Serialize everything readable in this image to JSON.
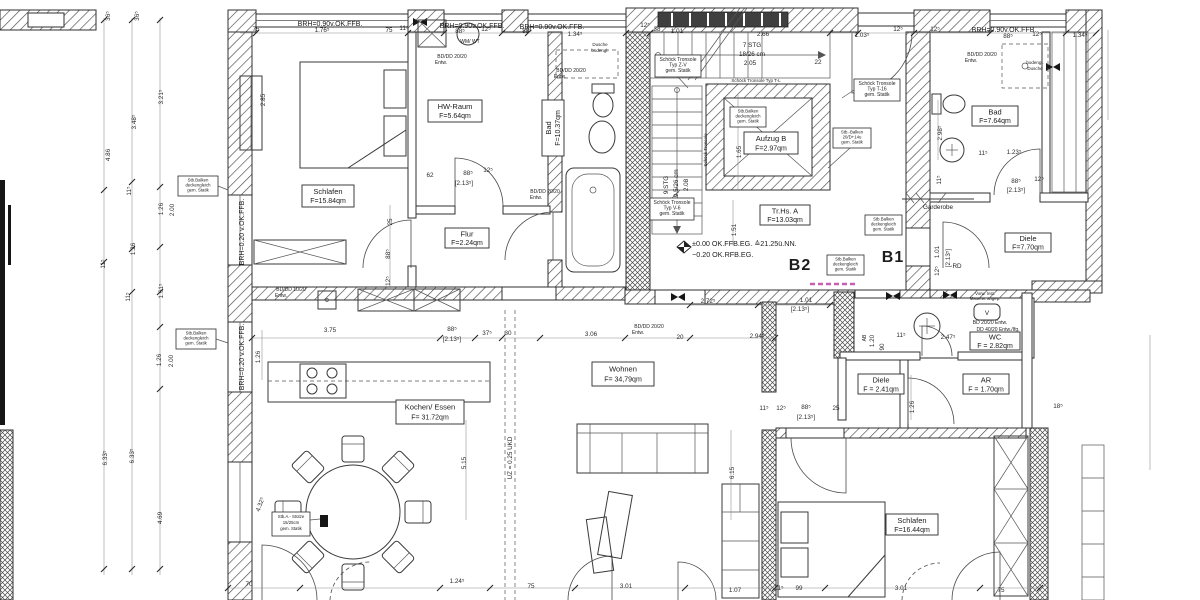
{
  "plan": {
    "units": {
      "b2": "B2",
      "b1": "B1"
    },
    "levels": {
      "l1": "±0.00  OK.FFB.EG. ≙21.25ü.NN.",
      "l2": "−0.20  OK.RFB.EG."
    },
    "rooms": [
      {
        "name": "Schlafen",
        "area": "F=15.84qm"
      },
      {
        "name": "HW-Raum",
        "area": "F=5.64qm"
      },
      {
        "name": "Bad",
        "area": "F=10.37qm"
      },
      {
        "name": "Flur",
        "area": "F=2.24qm"
      },
      {
        "name": "Kochen/ Essen",
        "area": "F= 31.72qm"
      },
      {
        "name": "Wohnen",
        "area": "F= 34,79qm"
      },
      {
        "name": "Tr.Hs.  A",
        "area": "F=13.03qm"
      },
      {
        "name": "Aufzug  B",
        "area": "F=2.97qm"
      },
      {
        "name": "Bad",
        "area": "F=7.64qm"
      },
      {
        "name": "Garderobe",
        "area": ""
      },
      {
        "name": "Diele",
        "area": "F=7.70qm"
      },
      {
        "name": "WC",
        "area": "F = 2.82qm"
      },
      {
        "name": "Diele",
        "area": "F = 2.41qm"
      },
      {
        "name": "AR",
        "area": "F = 1.70qm"
      },
      {
        "name": "Schlafen",
        "area": "F=16.44qm"
      }
    ],
    "stair": {
      "f1a": "7 STG",
      "f1b": "18/26 cm",
      "f1c": "2.05",
      "f2a": "9 STG",
      "f2b": "19,5/26 cm",
      "f2c": "2.08",
      "t1": "Schöck Tronsole Typ T-L",
      "t2": "Schöck Tronsole"
    },
    "windows": {
      "brh90": "BRH=0.90v.OK.FFB.",
      "brh20": "BRH=0.20 v.OK.FFB."
    },
    "notes": [
      {
        "l1": "Schöck Tronsole",
        "l2": "Typ Z-V",
        "l3": "gem. Statik"
      },
      {
        "l1": "Schöck Tronsole",
        "l2": "Typ T-16",
        "l3": "gem. Statik"
      },
      {
        "l1": "Schöck Tronsole",
        "l2": "Typ V-6",
        "l3": "gem. Statik"
      },
      {
        "l1": "Stb.Balken",
        "l2": "deckengleich",
        "l3": "gem. Statik"
      },
      {
        "l1": "Stb.-Balken",
        "l2": "20/D+14u",
        "l3": "gem. Statik"
      },
      {
        "l1": "Stb.Balken",
        "l2": "deckengleich",
        "l3": "gem. Statik"
      },
      {
        "l1": "Stb.Balken",
        "l2": "deckengleich",
        "l3": "gem. Statik"
      },
      {
        "l1": "Stb.Balken",
        "l2": "deckengleich",
        "l3": "gem. Statik"
      },
      {
        "l1": "Stb.Balken",
        "l2": "deckengleich",
        "l3": "gem. Statik"
      },
      {
        "l1": "Stb.A.- Stütze",
        "l2": "15/25cm",
        "l3": "gem. Statik"
      }
    ],
    "drains": [
      {
        "l1": "BD/DD 20/20",
        "l2": "Entw."
      },
      {
        "l1": "BD/DD 20/20",
        "l2": "Entw."
      },
      {
        "l1": "BD/DD 20/20",
        "l2": "Entw."
      },
      {
        "l1": "BD/DD 10/20",
        "l2": "Entw."
      },
      {
        "l1": "BD/DD 20/20",
        "l2": "Entw."
      },
      {
        "l1": "BD/DD 20/20",
        "l2": "Entw."
      },
      {
        "l1": "BD 20/20 Entw.",
        "l2": "DD 40/20 Entw./Ifg."
      }
    ],
    "misc": {
      "wm": "WM/ WT",
      "d1a": "Dusche",
      "d1b": "bodengl.",
      "d2a": "bodengl.",
      "d2b": "Dusche",
      "uz": "UZ = 0.25 UKD",
      "rd": "RD",
      "v": "V",
      "ab": "AB",
      "ab2": "1.20",
      "vorw1": "Vorw. Inst.",
      "vorw2": "Mauerw. angep."
    },
    "dims": [
      {
        "t": "36⁵",
        "x": 110,
        "y": 16,
        "r": -90
      },
      {
        "t": "36⁵",
        "x": 139,
        "y": 16,
        "r": -90
      },
      {
        "t": "3.21⁵",
        "x": 163,
        "y": 97,
        "r": -90
      },
      {
        "t": "3.48⁵",
        "x": 136,
        "y": 122,
        "r": -90
      },
      {
        "t": "4.86",
        "x": 110,
        "y": 155,
        "r": -90
      },
      {
        "t": "11⁵",
        "x": 131,
        "y": 191,
        "r": -90
      },
      {
        "t": "1.26",
        "x": 163,
        "y": 209,
        "r": -90
      },
      {
        "t": "2.00",
        "x": 174,
        "y": 210,
        "r": -90
      },
      {
        "t": "1.26",
        "x": 135,
        "y": 249,
        "r": -90
      },
      {
        "t": "11⁵",
        "x": 105,
        "y": 264,
        "r": -90
      },
      {
        "t": "1.61⁵",
        "x": 163,
        "y": 291,
        "r": -90
      },
      {
        "t": "11⁵",
        "x": 130,
        "y": 297,
        "r": -90
      },
      {
        "t": "1.26",
        "x": 161,
        "y": 360,
        "r": -90
      },
      {
        "t": "2.00",
        "x": 173,
        "y": 361,
        "r": -90
      },
      {
        "t": "6.33⁵",
        "x": 107,
        "y": 458,
        "r": -90
      },
      {
        "t": "6.33⁵",
        "x": 134,
        "y": 456,
        "r": -90
      },
      {
        "t": "4.69",
        "x": 162,
        "y": 518,
        "r": -90
      },
      {
        "t": "75",
        "x": 256,
        "y": 31
      },
      {
        "t": "1.76⁵",
        "x": 322,
        "y": 32
      },
      {
        "t": "75",
        "x": 389,
        "y": 32
      },
      {
        "t": "11⁵",
        "x": 404,
        "y": 30
      },
      {
        "t": "88⁵",
        "x": 460,
        "y": 33
      },
      {
        "t": "12⁵",
        "x": 486,
        "y": 31
      },
      {
        "t": "88⁵",
        "x": 527,
        "y": 33
      },
      {
        "t": "1.34⁵",
        "x": 575,
        "y": 36
      },
      {
        "t": "12⁵",
        "x": 645,
        "y": 27
      },
      {
        "t": "38",
        "x": 657,
        "y": 31
      },
      {
        "t": "1.01",
        "x": 677,
        "y": 33
      },
      {
        "t": "2.66",
        "x": 763,
        "y": 36
      },
      {
        "t": "1.03⁵",
        "x": 862,
        "y": 37
      },
      {
        "t": "22",
        "x": 818,
        "y": 64
      },
      {
        "t": "12⁵",
        "x": 898,
        "y": 31
      },
      {
        "t": "12⁵",
        "x": 935,
        "y": 31
      },
      {
        "t": "88⁵",
        "x": 1008,
        "y": 38
      },
      {
        "t": "12⁵",
        "x": 1037,
        "y": 36
      },
      {
        "t": "1.34⁵",
        "x": 1080,
        "y": 37
      },
      {
        "t": "2.85",
        "x": 265,
        "y": 100,
        "r": -90
      },
      {
        "t": "62",
        "x": 430,
        "y": 177
      },
      {
        "t": "88⁵",
        "x": 468,
        "y": 175
      },
      {
        "t": "[2.13⁵]",
        "x": 464,
        "y": 185
      },
      {
        "t": "12⁵",
        "x": 488,
        "y": 172
      },
      {
        "t": "25",
        "x": 392,
        "y": 222,
        "r": -90
      },
      {
        "t": "88⁵",
        "x": 390,
        "y": 254,
        "r": -90
      },
      {
        "t": "12⁵",
        "x": 390,
        "y": 281,
        "r": -90
      },
      {
        "t": "1.65",
        "x": 741,
        "y": 152,
        "r": -90
      },
      {
        "t": "1.51",
        "x": 736,
        "y": 230,
        "r": -90
      },
      {
        "t": "2.72⁵",
        "x": 708,
        "y": 303
      },
      {
        "t": "1.01",
        "x": 806,
        "y": 302
      },
      {
        "t": "[2.13⁵]",
        "x": 800,
        "y": 311
      },
      {
        "t": "2.94⁵",
        "x": 757,
        "y": 338
      },
      {
        "t": "3.06",
        "x": 591,
        "y": 336
      },
      {
        "t": "20",
        "x": 680,
        "y": 339
      },
      {
        "t": "3.75",
        "x": 330,
        "y": 332
      },
      {
        "t": "88⁵",
        "x": 452,
        "y": 331
      },
      {
        "t": "[2.13⁵]",
        "x": 452,
        "y": 341
      },
      {
        "t": "37⁵",
        "x": 487,
        "y": 335
      },
      {
        "t": "30",
        "x": 508,
        "y": 335
      },
      {
        "t": "1.26",
        "x": 260,
        "y": 357,
        "r": -90
      },
      {
        "t": "5.15",
        "x": 466,
        "y": 463,
        "r": -90
      },
      {
        "t": "6.15",
        "x": 734,
        "y": 473,
        "r": -90
      },
      {
        "t": "4.32⁵",
        "x": 262,
        "y": 505,
        "r": -70
      },
      {
        "t": "2.98⁵",
        "x": 942,
        "y": 133,
        "r": -90
      },
      {
        "t": "11⁵",
        "x": 983,
        "y": 155
      },
      {
        "t": "1.23⁵",
        "x": 1014,
        "y": 154
      },
      {
        "t": "88⁵",
        "x": 1016,
        "y": 183
      },
      {
        "t": "[2.13⁵]",
        "x": 1016,
        "y": 192
      },
      {
        "t": "12⁵",
        "x": 1039,
        "y": 181
      },
      {
        "t": "11⁵",
        "x": 941,
        "y": 180,
        "r": -90
      },
      {
        "t": "2.47⁵",
        "x": 948,
        "y": 339
      },
      {
        "t": "90",
        "x": 884,
        "y": 347,
        "r": -90
      },
      {
        "t": "1.20",
        "x": 874,
        "y": 341,
        "r": -90
      },
      {
        "t": "11⁵",
        "x": 901,
        "y": 337
      },
      {
        "t": "1.26",
        "x": 914,
        "y": 407,
        "r": -90
      },
      {
        "t": "25",
        "x": 836,
        "y": 410
      },
      {
        "t": "1.01",
        "x": 939,
        "y": 252,
        "r": -90
      },
      {
        "t": "[2.13⁵]",
        "x": 950,
        "y": 258,
        "r": -90
      },
      {
        "t": "12⁵",
        "x": 939,
        "y": 271,
        "r": -90
      },
      {
        "t": "11⁵",
        "x": 764,
        "y": 410
      },
      {
        "t": "12⁵",
        "x": 781,
        "y": 410
      },
      {
        "t": "88⁵",
        "x": 806,
        "y": 409
      },
      {
        "t": "[2.13⁵]",
        "x": 806,
        "y": 419
      },
      {
        "t": "70",
        "x": 249,
        "y": 586
      },
      {
        "t": "1.24⁵",
        "x": 457,
        "y": 583
      },
      {
        "t": "75",
        "x": 531,
        "y": 588
      },
      {
        "t": "3.01",
        "x": 626,
        "y": 588
      },
      {
        "t": "1.07",
        "x": 735,
        "y": 592
      },
      {
        "t": "11⁵",
        "x": 779,
        "y": 590
      },
      {
        "t": "99",
        "x": 799,
        "y": 590
      },
      {
        "t": "3.01",
        "x": 901,
        "y": 590
      },
      {
        "t": "75",
        "x": 1001,
        "y": 592
      },
      {
        "t": "18⁵",
        "x": 1058,
        "y": 408
      }
    ]
  }
}
